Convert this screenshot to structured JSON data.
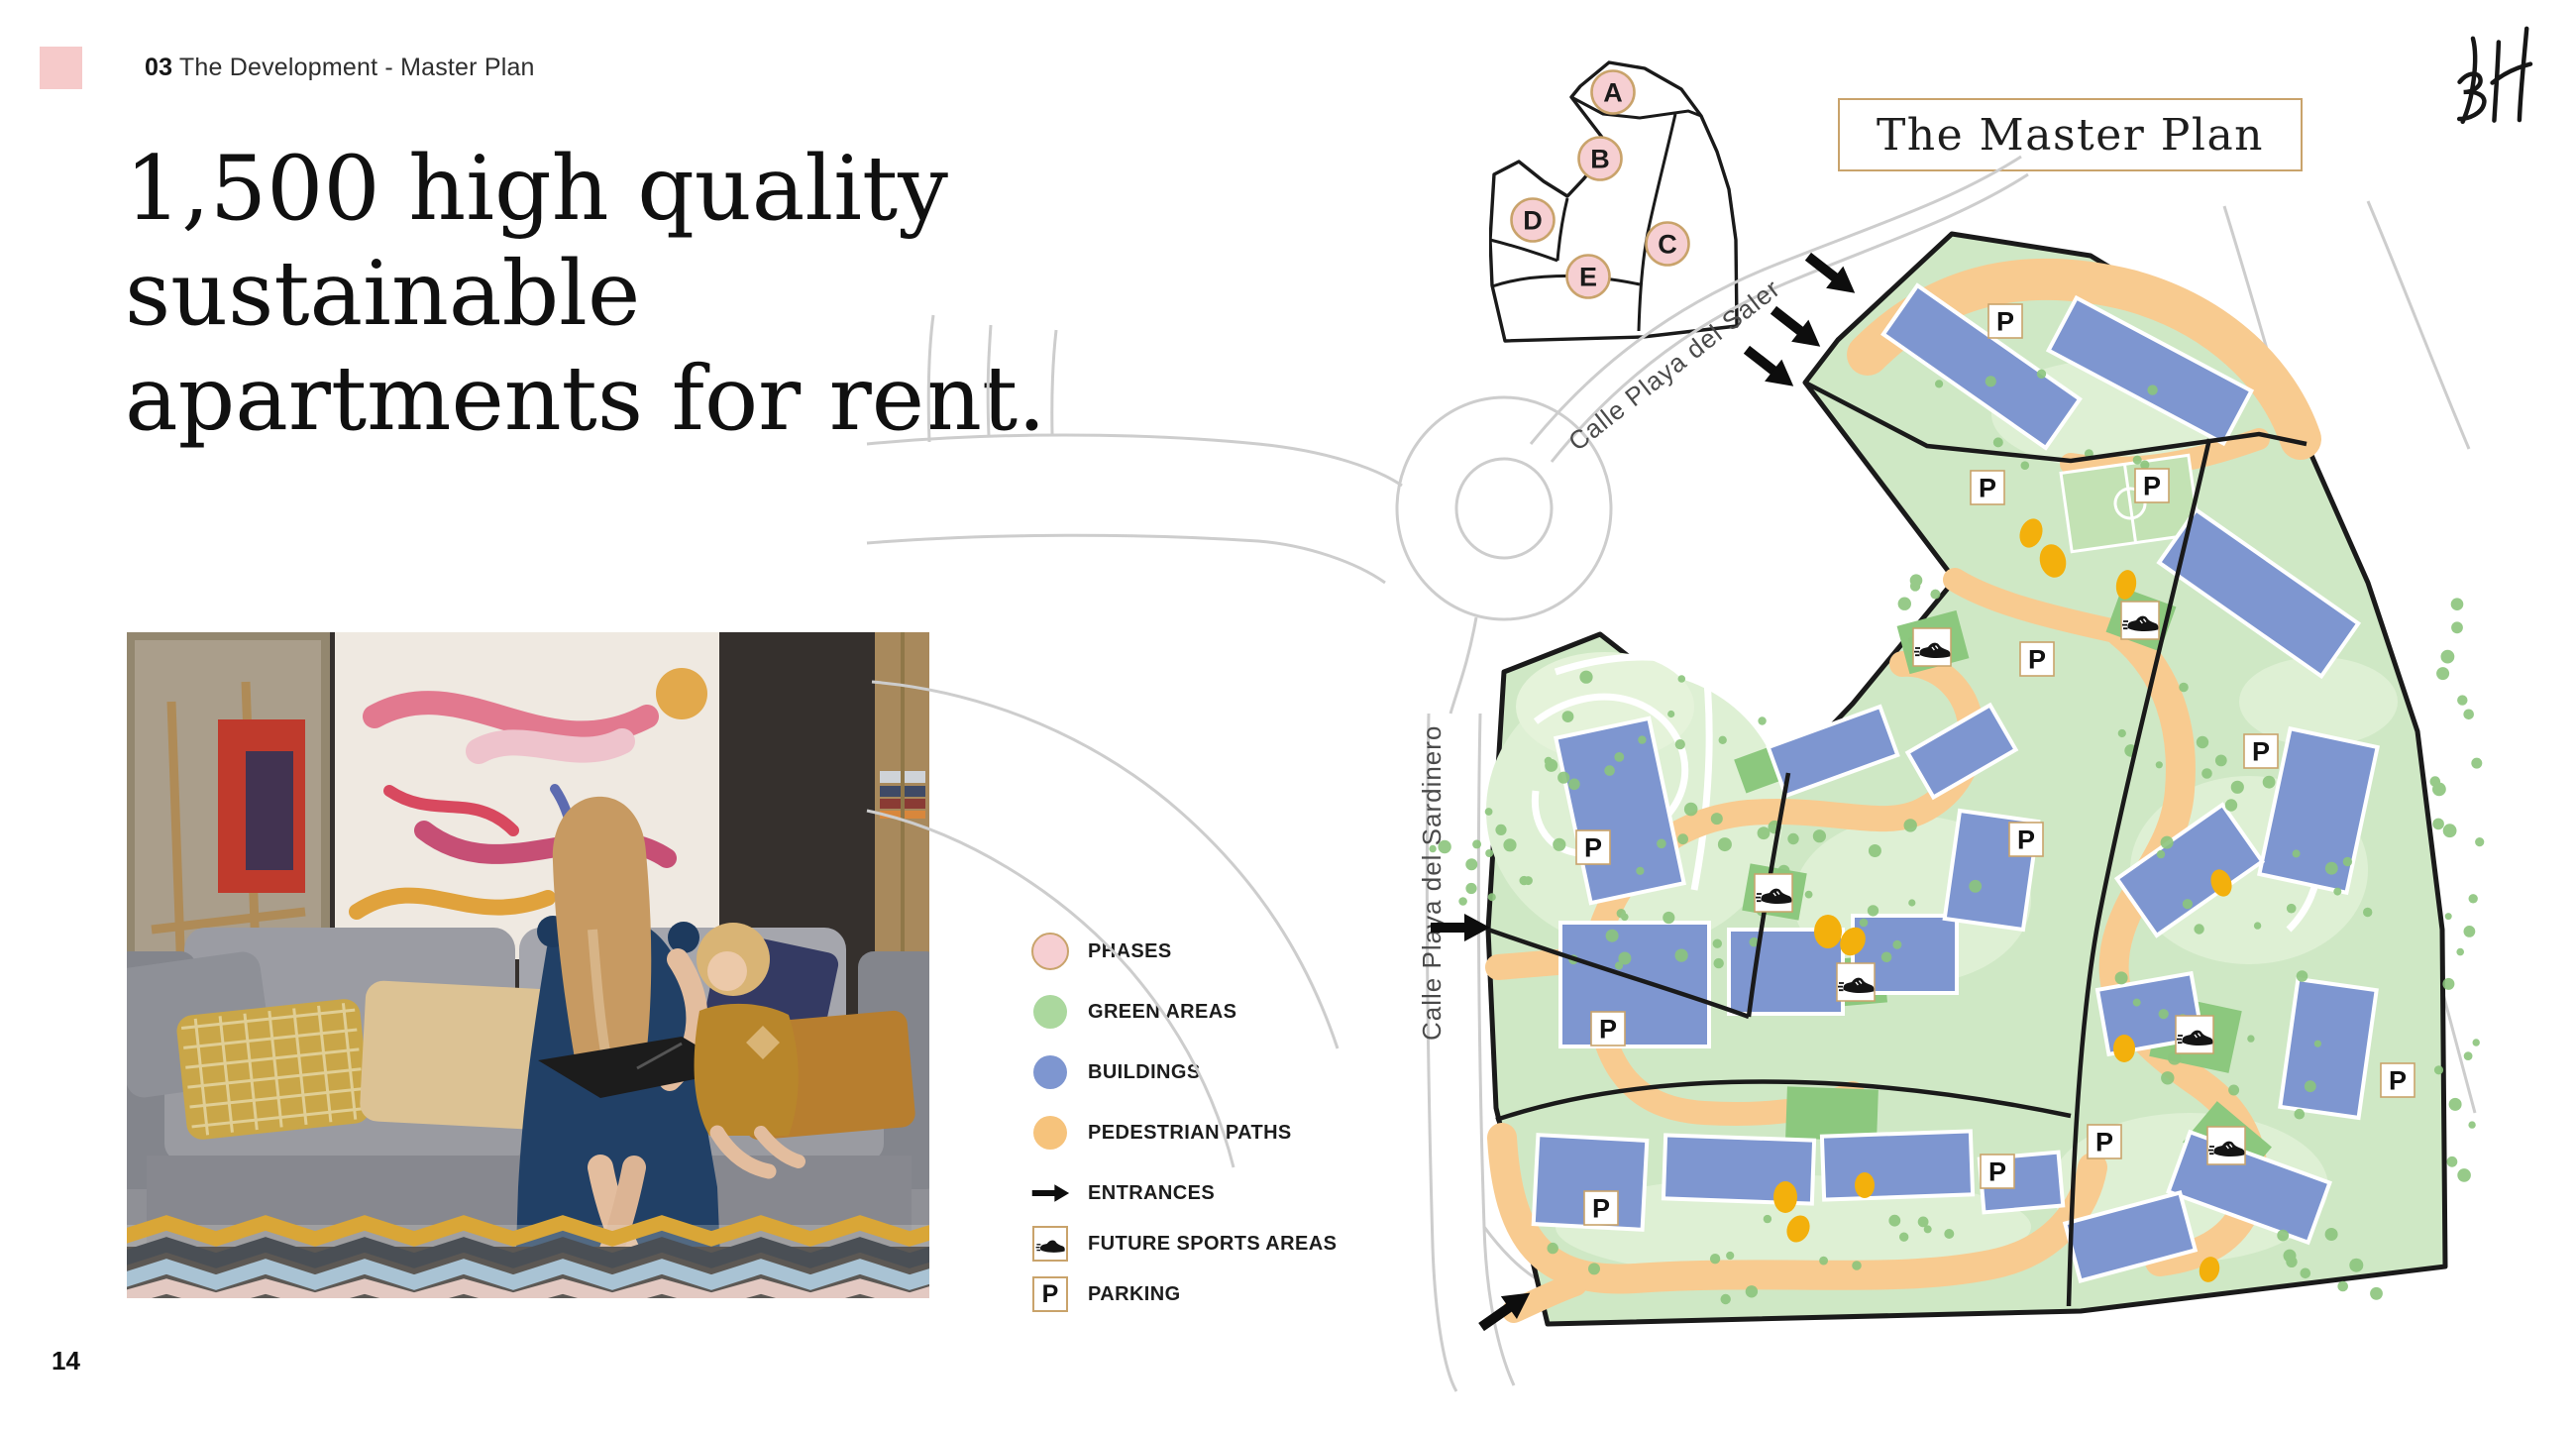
{
  "header": {
    "section_number": "03",
    "section_title": "The Development - Master Plan"
  },
  "logo": {
    "text": "BH"
  },
  "headline": {
    "line1": "1,500 high quality",
    "line2": "sustainable",
    "line3": "apartments for rent."
  },
  "page_number": "14",
  "map": {
    "title": "The Master Plan",
    "streets": [
      {
        "name": "Calle Playa del Saler"
      },
      {
        "name": "Calle Playa del Sardinero"
      }
    ],
    "phases": [
      "A",
      "B",
      "C",
      "D",
      "E"
    ],
    "parking_label": "P",
    "parking_count": 12,
    "sports_area_count": 6,
    "entrance_count": 5
  },
  "legend": {
    "items": [
      {
        "id": "phases",
        "label": "PHASES",
        "icon": "circle",
        "color": "#f6cfd2",
        "border": "#c9a36b"
      },
      {
        "id": "green-areas",
        "label": "GREEN AREAS",
        "icon": "circle",
        "color": "#abd89e"
      },
      {
        "id": "buildings",
        "label": "BUILDINGS",
        "icon": "circle",
        "color": "#7e96d0"
      },
      {
        "id": "pedestrian-paths",
        "label": "PEDESTRIAN PATHS",
        "icon": "circle",
        "color": "#f6c37c"
      },
      {
        "id": "entrances",
        "label": "ENTRANCES",
        "icon": "arrow"
      },
      {
        "id": "future-sports-areas",
        "label": "FUTURE SPORTS AREAS",
        "icon": "shoe"
      },
      {
        "id": "parking",
        "label": "PARKING",
        "icon": "P"
      }
    ]
  },
  "colors": {
    "accent_pink": "#f6caca",
    "phase_pink": "#f6cfd2",
    "gold": "#c9a36b",
    "green_area": "#cfe8c5",
    "building_blue": "#7e96d0",
    "path_orange": "#f8cb90",
    "sports_green": "#8cc87e",
    "play_yellow": "#f3b00c"
  }
}
